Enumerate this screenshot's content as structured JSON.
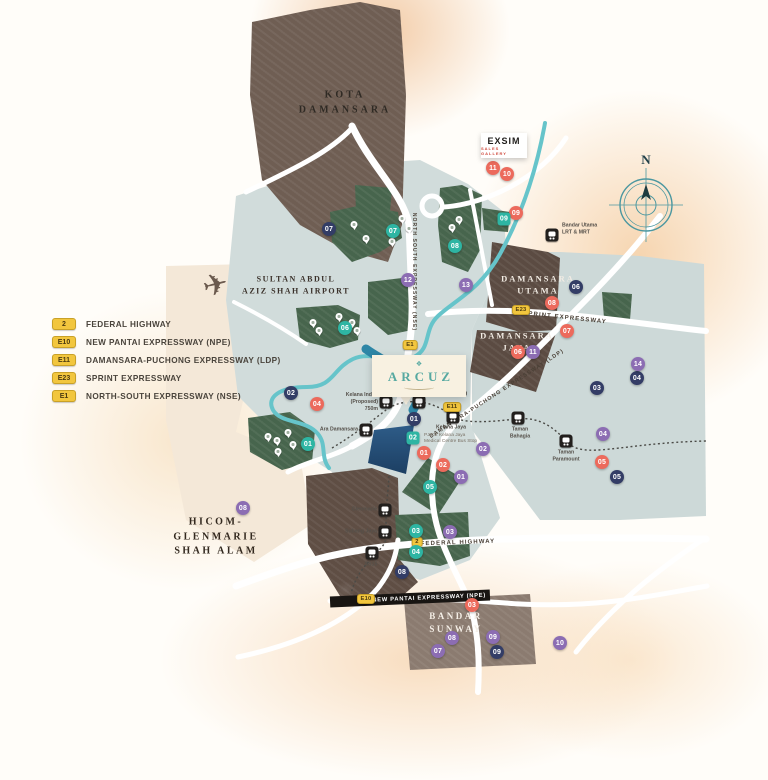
{
  "colors": {
    "salmon": "#ec6a5c",
    "teal": "#2eb5a3",
    "navy": "#333d66",
    "purple": "#8c6db3",
    "shield": "#f2c63e",
    "accent": "#57a9a1",
    "river": "#66c4ca",
    "road": "#ffffff"
  },
  "compass_label": "N",
  "callouts": {
    "arcuz": {
      "name": "ARCUZ"
    },
    "exsim": {
      "name": "EXSIM",
      "sub": "SALES GALLERY"
    }
  },
  "npe_band": {
    "text": "NEW PANTAI EXPRESSWAY (NPE)"
  },
  "legend": [
    {
      "shield": "2",
      "label": "FEDERAL HIGHWAY"
    },
    {
      "shield": "E10",
      "label": "NEW PANTAI EXPRESSWAY (NPE)"
    },
    {
      "shield": "E11",
      "label": "DAMANSARA-PUCHONG EXPRESSWAY (LDP)"
    },
    {
      "shield": "E23",
      "label": "SPRINT EXPRESSWAY"
    },
    {
      "shield": "E1",
      "label": "NORTH-SOUTH EXPRESSWAY (NSE)"
    }
  ],
  "area_labels": [
    {
      "id": "kota-damansara",
      "text": "KOTA\nDAMANSARA",
      "x": 345,
      "y": 103,
      "color": "#2f2a24",
      "size": 10,
      "ls": 3
    },
    {
      "id": "airport",
      "text": "SULTAN ABDUL\nAZIZ SHAH AIRPORT",
      "x": 296,
      "y": 285,
      "color": "#3a312a",
      "size": 8,
      "ls": 1.5
    },
    {
      "id": "damansara-utama",
      "text": "DAMANSARA\nUTAMA",
      "x": 538,
      "y": 285,
      "color": "#f2ece4",
      "size": 8.5,
      "ls": 2
    },
    {
      "id": "damansara-jaya",
      "text": "DAMANSARA\nJAYA",
      "x": 517,
      "y": 342,
      "color": "#f2ece4",
      "size": 8.5,
      "ls": 2
    },
    {
      "id": "hicom-glenmarie",
      "text": "HICOM-\nGLENMARIE\nSHAH ALAM",
      "x": 216,
      "y": 537,
      "color": "#33291f",
      "size": 10,
      "ls": 2.5
    },
    {
      "id": "bandar-sunway",
      "text": "BANDAR\nSUNWAY",
      "x": 456,
      "y": 623,
      "color": "#f4eee6",
      "size": 9,
      "ls": 2.5
    }
  ],
  "road_labels": [
    {
      "id": "nse",
      "text": "NORTH SOUTH EXPRESSWAY (NSE)",
      "x": 414,
      "y": 272,
      "rot": 90,
      "size": 5
    },
    {
      "id": "sprint",
      "text": "SPRINT EXPRESSWAY",
      "x": 565,
      "y": 318,
      "rot": 6,
      "size": 6
    },
    {
      "id": "ldp",
      "text": "DAMANSARA-PUCHONG EXPRESSWAY (LDP)",
      "x": 497,
      "y": 394,
      "rot": -33,
      "size": 5.5
    },
    {
      "id": "federal",
      "text": "FEDERAL HIGHWAY",
      "x": 458,
      "y": 543,
      "rot": -2,
      "size": 6
    }
  ],
  "shields": [
    {
      "t": "E23",
      "x": 521,
      "y": 310
    },
    {
      "t": "E11",
      "x": 452,
      "y": 407
    },
    {
      "t": "E1",
      "x": 410,
      "y": 345
    },
    {
      "t": "2",
      "x": 417,
      "y": 542
    },
    {
      "t": "E10",
      "x": 366,
      "y": 599
    }
  ],
  "stations": [
    {
      "name": "Bandar Utama\nLRT & MRT",
      "x": 552,
      "y": 235,
      "lx": 562,
      "ly": 229,
      "align": "left"
    },
    {
      "name": "Kelana Indah\n(Proposed)\n750m",
      "x": 386,
      "y": 402,
      "lx": 378,
      "ly": 402,
      "align": "right"
    },
    {
      "name": "Lembah Subang",
      "x": 419,
      "y": 402,
      "lx": 427,
      "ly": 394,
      "align": "left"
    },
    {
      "name": "Kelana Jaya",
      "x": 453,
      "y": 417,
      "lx": 451,
      "ly": 428,
      "align": "center"
    },
    {
      "name": "Taman\nBahagia",
      "x": 518,
      "y": 418,
      "lx": 520,
      "ly": 433,
      "align": "center"
    },
    {
      "name": "Taman\nParamount",
      "x": 566,
      "y": 441,
      "lx": 566,
      "ly": 456,
      "align": "center"
    },
    {
      "name": "Ara Damansara",
      "x": 366,
      "y": 430,
      "lx": 358,
      "ly": 430,
      "align": "right"
    },
    {
      "name": "Glenmarie",
      "x": 385,
      "y": 510,
      "lx": 377,
      "ly": 510,
      "align": "right"
    },
    {
      "name": "Subang Jaya",
      "x": 385,
      "y": 532,
      "lx": 377,
      "ly": 532,
      "align": "right"
    },
    {
      "name": "SS15",
      "x": 372,
      "y": 553,
      "lx": 371,
      "ly": 565,
      "align": "center"
    }
  ],
  "small_labels": [
    {
      "text": "PJ302 Kelana Jaya\nMedical Centre Bus Stop",
      "x": 424,
      "y": 439,
      "align": "left",
      "color": "#7a7166",
      "size": 4.8
    }
  ],
  "markers": [
    {
      "n": "11",
      "c": "salmon",
      "x": 493,
      "y": 168
    },
    {
      "n": "10",
      "c": "salmon",
      "x": 507,
      "y": 174
    },
    {
      "n": "09",
      "c": "salmon",
      "x": 516,
      "y": 213
    },
    {
      "n": "08",
      "c": "salmon",
      "x": 552,
      "y": 303
    },
    {
      "n": "07",
      "c": "salmon",
      "x": 567,
      "y": 331
    },
    {
      "n": "06",
      "c": "salmon",
      "x": 518,
      "y": 352
    },
    {
      "n": "04",
      "c": "salmon",
      "x": 317,
      "y": 404
    },
    {
      "n": "01",
      "c": "salmon",
      "x": 424,
      "y": 453
    },
    {
      "n": "02",
      "c": "salmon",
      "x": 443,
      "y": 465
    },
    {
      "n": "05",
      "c": "salmon",
      "x": 602,
      "y": 462
    },
    {
      "n": "03",
      "c": "salmon",
      "x": 472,
      "y": 605
    },
    {
      "n": "07",
      "c": "teal",
      "x": 393,
      "y": 231
    },
    {
      "n": "08",
      "c": "teal",
      "x": 455,
      "y": 246
    },
    {
      "n": "09",
      "c": "teal",
      "x": 504,
      "y": 219,
      "s": "square"
    },
    {
      "n": "06",
      "c": "teal",
      "x": 345,
      "y": 328
    },
    {
      "n": "02",
      "c": "teal",
      "x": 413,
      "y": 438,
      "s": "square"
    },
    {
      "n": "01",
      "c": "teal",
      "x": 308,
      "y": 444
    },
    {
      "n": "05",
      "c": "teal",
      "x": 430,
      "y": 487
    },
    {
      "n": "03",
      "c": "teal",
      "x": 416,
      "y": 531
    },
    {
      "n": "04",
      "c": "teal",
      "x": 416,
      "y": 552
    },
    {
      "n": "07",
      "c": "navy",
      "x": 329,
      "y": 229
    },
    {
      "n": "06",
      "c": "navy",
      "x": 576,
      "y": 287
    },
    {
      "n": "04",
      "c": "navy",
      "x": 637,
      "y": 378
    },
    {
      "n": "03",
      "c": "navy",
      "x": 597,
      "y": 388
    },
    {
      "n": "02",
      "c": "navy",
      "x": 291,
      "y": 393
    },
    {
      "n": "01",
      "c": "navy",
      "x": 414,
      "y": 419
    },
    {
      "n": "05",
      "c": "navy",
      "x": 617,
      "y": 477
    },
    {
      "n": "08",
      "c": "navy",
      "x": 402,
      "y": 572
    },
    {
      "n": "09",
      "c": "navy",
      "x": 497,
      "y": 652
    },
    {
      "n": "12",
      "c": "purple",
      "x": 408,
      "y": 280
    },
    {
      "n": "13",
      "c": "purple",
      "x": 466,
      "y": 285
    },
    {
      "n": "11",
      "c": "purple",
      "x": 533,
      "y": 352
    },
    {
      "n": "14",
      "c": "purple",
      "x": 638,
      "y": 364
    },
    {
      "n": "04",
      "c": "purple",
      "x": 603,
      "y": 434
    },
    {
      "n": "02",
      "c": "purple",
      "x": 483,
      "y": 449
    },
    {
      "n": "01",
      "c": "purple",
      "x": 461,
      "y": 477
    },
    {
      "n": "08",
      "c": "purple",
      "x": 243,
      "y": 508
    },
    {
      "n": "03",
      "c": "purple",
      "x": 450,
      "y": 532
    },
    {
      "n": "08",
      "c": "purple",
      "x": 452,
      "y": 638
    },
    {
      "n": "09",
      "c": "purple",
      "x": 493,
      "y": 637
    },
    {
      "n": "07",
      "c": "purple",
      "x": 438,
      "y": 651
    },
    {
      "n": "10",
      "c": "purple",
      "x": 560,
      "y": 643
    }
  ],
  "pins": [
    [
      402,
      222
    ],
    [
      409,
      232
    ],
    [
      392,
      245
    ],
    [
      354,
      228
    ],
    [
      366,
      242
    ],
    [
      452,
      231
    ],
    [
      459,
      223
    ],
    [
      313,
      326
    ],
    [
      319,
      334
    ],
    [
      352,
      326
    ],
    [
      357,
      334
    ],
    [
      339,
      320
    ],
    [
      268,
      440
    ],
    [
      277,
      444
    ],
    [
      288,
      436
    ],
    [
      293,
      448
    ],
    [
      278,
      455
    ]
  ]
}
